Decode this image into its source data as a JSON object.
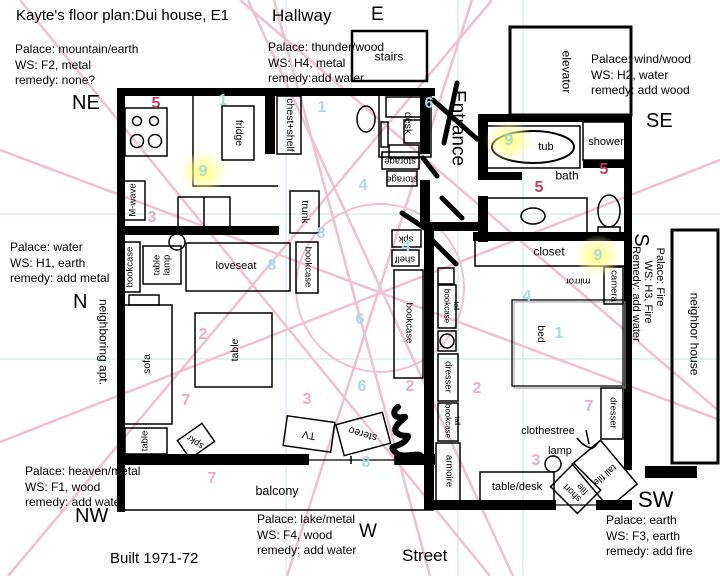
{
  "colors": {
    "star_red": "#c9395f",
    "star_pink": "#eeacbf",
    "star_cyan": "#a9dbe2",
    "sector_line_pink": "#eec3d0",
    "grid_teal": "#cdeaea",
    "highlight_yellow": "#ffff96",
    "ink": "#000000"
  },
  "labels": [
    {
      "id": "title",
      "t": "Kayte's floor plan:Dui house, E1",
      "x": 16,
      "y": 8,
      "cls": "tl t15"
    },
    {
      "id": "hallway",
      "t": "Hallway",
      "x": 272,
      "y": 6,
      "cls": "tl t17"
    },
    {
      "id": "dir-e",
      "t": "E",
      "x": 371,
      "y": 4,
      "cls": "tl t19"
    },
    {
      "id": "stairs",
      "t": "stairs",
      "x": 389,
      "y": 57,
      "cls": "c t12"
    },
    {
      "id": "palace-ne",
      "t": "Palace: mountain/earth\nWS: F2, metal\nremedy: none?",
      "x": 15,
      "y": 42,
      "cls": "tl blk"
    },
    {
      "id": "dir-ne",
      "t": "NE",
      "x": 72,
      "y": 92,
      "cls": "tl t20"
    },
    {
      "id": "palace-e",
      "t": "Palace: thunder/wood\nWS: H4, metal\nremedy:add water",
      "x": 268,
      "y": 40,
      "cls": "tl blk"
    },
    {
      "id": "palace-se",
      "t": "Palace: wind/wood\nWS: H2, water\nremedy: add wood",
      "x": 591,
      "y": 52,
      "cls": "tl blk"
    },
    {
      "id": "dir-se",
      "t": "SE",
      "x": 646,
      "y": 110,
      "cls": "tl t20"
    },
    {
      "id": "entrance",
      "t": "Entrance",
      "x": 458,
      "y": 128,
      "cls": "c t19",
      "rot": 90
    },
    {
      "id": "elevator",
      "t": "elevator",
      "x": 566,
      "y": 72,
      "cls": "c t12",
      "rot": 90
    },
    {
      "id": "tub",
      "t": "tub",
      "x": 546,
      "y": 147,
      "cls": "c t11"
    },
    {
      "id": "shower",
      "t": "shower",
      "x": 606,
      "y": 142,
      "cls": "c t11"
    },
    {
      "id": "bath",
      "t": "bath",
      "x": 567,
      "y": 176,
      "cls": "c t12"
    },
    {
      "id": "closet",
      "t": "closet",
      "x": 549,
      "y": 252,
      "cls": "c t12"
    },
    {
      "id": "camera",
      "t": "camera",
      "x": 613,
      "y": 286,
      "cls": "c t9",
      "rot": 90
    },
    {
      "id": "mirror",
      "t": "mirror",
      "x": 578,
      "y": 280,
      "cls": "c t9",
      "rot": 180
    },
    {
      "id": "dir-s",
      "t": "S",
      "x": 641,
      "y": 240,
      "cls": "c t20",
      "rot": 90
    },
    {
      "id": "palace-s-1",
      "t": "Palace: Fire",
      "x": 660,
      "y": 277,
      "cls": "c t11",
      "rot": 90
    },
    {
      "id": "palace-s-2",
      "t": "WS: H3, Fire",
      "x": 648,
      "y": 292,
      "cls": "c t11",
      "rot": 90
    },
    {
      "id": "palace-s-3",
      "t": "Remedy: add water",
      "x": 636,
      "y": 294,
      "cls": "c t11",
      "rot": 90
    },
    {
      "id": "neighbor-house",
      "t": "neighbor house",
      "x": 694,
      "y": 334,
      "cls": "c t12",
      "rot": 90
    },
    {
      "id": "palace-n",
      "t": "Palace: water\nWS: H1, earth\nremedy: add metal",
      "x": 10,
      "y": 240,
      "cls": "tl blk"
    },
    {
      "id": "dir-n",
      "t": "N",
      "x": 73,
      "y": 291,
      "cls": "tl t20"
    },
    {
      "id": "neighboring-apt",
      "t": "neighboring apt.",
      "x": 103,
      "y": 342,
      "cls": "c t12",
      "rot": 90
    },
    {
      "id": "fridge",
      "t": "fridge",
      "x": 238,
      "y": 133,
      "cls": "c t10",
      "rot": 90
    },
    {
      "id": "chest-shelf",
      "t": "chest+shelf",
      "x": 289,
      "y": 125,
      "cls": "c t10",
      "rot": 90
    },
    {
      "id": "m-wave",
      "t": "M-wave",
      "x": 134,
      "y": 200,
      "cls": "c t9",
      "rot": -90
    },
    {
      "id": "trunk",
      "t": "trunk",
      "x": 304,
      "y": 212,
      "cls": "c t10",
      "rot": 90
    },
    {
      "id": "desk",
      "t": "desk",
      "x": 407,
      "y": 123,
      "cls": "c t10",
      "rot": 90
    },
    {
      "id": "storage-1",
      "t": "storage",
      "x": 400,
      "y": 160,
      "cls": "c t9",
      "rot": 180
    },
    {
      "id": "storage-2",
      "t": "storage",
      "x": 402,
      "y": 178,
      "cls": "c t9",
      "rot": 180
    },
    {
      "id": "bookcase-nw",
      "t": "bookcase",
      "x": 131,
      "y": 267,
      "cls": "c t9",
      "rot": -90
    },
    {
      "id": "table-lamp",
      "t": "table\nlamp",
      "x": 162,
      "y": 265,
      "cls": "c t9 lh",
      "rot": -90
    },
    {
      "id": "loveseat",
      "t": "loveseat",
      "x": 236,
      "y": 266,
      "cls": "c t11"
    },
    {
      "id": "bookcase-mid",
      "t": "bookcase",
      "x": 307,
      "y": 267,
      "cls": "c t9",
      "rot": 90
    },
    {
      "id": "sofa",
      "t": "sofa",
      "x": 148,
      "y": 364,
      "cls": "c t10",
      "rot": -90
    },
    {
      "id": "table-dining",
      "t": "table",
      "x": 236,
      "y": 350,
      "cls": "c t10",
      "rot": -90
    },
    {
      "id": "table-small",
      "t": "table",
      "x": 146,
      "y": 441,
      "cls": "c t9",
      "rot": -90
    },
    {
      "id": "spkr",
      "t": "spkr",
      "x": 196,
      "y": 441,
      "cls": "c t9",
      "rot": 215
    },
    {
      "id": "tv",
      "t": "TV",
      "x": 309,
      "y": 434,
      "cls": "c t10",
      "rot": 190
    },
    {
      "id": "stereo",
      "t": "stereo",
      "x": 363,
      "y": 433,
      "cls": "c t10",
      "rot": 197
    },
    {
      "id": "spk",
      "t": "spk",
      "x": 406,
      "y": 238,
      "cls": "c t9",
      "rot": 180
    },
    {
      "id": "shelf",
      "t": "shelf",
      "x": 405,
      "y": 258,
      "cls": "c t9",
      "rot": 180
    },
    {
      "id": "bookcase-wall",
      "t": "bookcase",
      "x": 408,
      "y": 323,
      "cls": "c t9",
      "rot": 90
    },
    {
      "id": "bookcase-bed1",
      "t": "bookcase",
      "x": 446,
      "y": 306,
      "cls": "c t8",
      "rot": 90
    },
    {
      "id": "tall-1",
      "t": "tall",
      "x": 455,
      "y": 306,
      "cls": "c t7",
      "rot": 90
    },
    {
      "id": "dresser-bed-l",
      "t": "dresser",
      "x": 447,
      "y": 377,
      "cls": "c t9",
      "rot": 90
    },
    {
      "id": "bookcase-bed2",
      "t": "bookcase",
      "x": 447,
      "y": 421,
      "cls": "c t8",
      "rot": 90
    },
    {
      "id": "tall-2",
      "t": "tall",
      "x": 456,
      "y": 421,
      "cls": "c t7",
      "rot": 90
    },
    {
      "id": "armoire",
      "t": "armoire",
      "x": 448,
      "y": 471,
      "cls": "c t9",
      "rot": 90
    },
    {
      "id": "bed",
      "t": "bed",
      "x": 540,
      "y": 334,
      "cls": "c t10",
      "rot": 90
    },
    {
      "id": "dresser-bed-r",
      "t": "dresser",
      "x": 612,
      "y": 413,
      "cls": "c t9",
      "rot": 90
    },
    {
      "id": "clothestree",
      "t": "clothestree",
      "x": 548,
      "y": 431,
      "cls": "c t11"
    },
    {
      "id": "lamp",
      "t": "lamp",
      "x": 560,
      "y": 451,
      "cls": "c t11"
    },
    {
      "id": "table-desk",
      "t": "table/desk",
      "x": 517,
      "y": 487,
      "cls": "c t11"
    },
    {
      "id": "short-file",
      "t": "short\nfile",
      "x": 576,
      "y": 489,
      "cls": "c t9 lh",
      "rot": 225
    },
    {
      "id": "tall-file",
      "t": "tall file",
      "x": 604,
      "y": 474,
      "cls": "c t9",
      "rot": 140
    },
    {
      "id": "balcony",
      "t": "balcony",
      "x": 277,
      "y": 491,
      "cls": "c t13"
    },
    {
      "id": "palace-nw",
      "t": "Palace: heaven/metal\nWS: F1, wood\nremedy: add water",
      "x": 25,
      "y": 464,
      "cls": "tl blk"
    },
    {
      "id": "dir-nw",
      "t": "NW",
      "x": 75,
      "y": 505,
      "cls": "tl t20"
    },
    {
      "id": "built",
      "t": "Built 1971-72",
      "x": 110,
      "y": 551,
      "cls": "tl t15"
    },
    {
      "id": "palace-w",
      "t": "Palace: lake/metal\nWS: F4, wood\nremedy: add water",
      "x": 257,
      "y": 512,
      "cls": "tl blk"
    },
    {
      "id": "dir-w",
      "t": "W",
      "x": 359,
      "y": 521,
      "cls": "tl t19"
    },
    {
      "id": "street",
      "t": "Street",
      "x": 402,
      "y": 546,
      "cls": "tl t17"
    },
    {
      "id": "dir-sw",
      "t": "SW",
      "x": 638,
      "y": 488,
      "cls": "tl t22"
    },
    {
      "id": "palace-sw",
      "t": "Palace: earth\nWS: F3, earth\nremedy: add fire",
      "x": 606,
      "y": 513,
      "cls": "tl blk"
    }
  ],
  "stars": [
    {
      "v": "5",
      "c": "r",
      "x": 156,
      "y": 104
    },
    {
      "v": "1",
      "c": "b",
      "x": 223,
      "y": 101
    },
    {
      "v": "1",
      "c": "b",
      "x": 322,
      "y": 108
    },
    {
      "v": "6",
      "c": "b",
      "x": 429,
      "y": 104
    },
    {
      "v": "9",
      "c": "b",
      "x": 203,
      "y": 172,
      "glow": true
    },
    {
      "v": "3",
      "c": "p",
      "x": 152,
      "y": 218
    },
    {
      "v": "4",
      "c": "b",
      "x": 363,
      "y": 186
    },
    {
      "v": "8",
      "c": "b",
      "x": 321,
      "y": 234
    },
    {
      "v": "8",
      "c": "b",
      "x": 272,
      "y": 266
    },
    {
      "v": "4",
      "c": "b",
      "x": 406,
      "y": 247
    },
    {
      "v": "2",
      "c": "p",
      "x": 203,
      "y": 335
    },
    {
      "v": "6",
      "c": "b",
      "x": 360,
      "y": 320
    },
    {
      "v": "6",
      "c": "b",
      "x": 362,
      "y": 387
    },
    {
      "v": "2",
      "c": "p",
      "x": 410,
      "y": 387
    },
    {
      "v": "7",
      "c": "p",
      "x": 186,
      "y": 401
    },
    {
      "v": "3",
      "c": "p",
      "x": 307,
      "y": 400
    },
    {
      "v": "8",
      "c": "b",
      "x": 366,
      "y": 463
    },
    {
      "v": "7",
      "c": "p",
      "x": 212,
      "y": 479
    },
    {
      "v": "9",
      "c": "b",
      "x": 509,
      "y": 141,
      "glow": true
    },
    {
      "v": "5",
      "c": "r",
      "x": 604,
      "y": 170
    },
    {
      "v": "5",
      "c": "r",
      "x": 539,
      "y": 188
    },
    {
      "v": "9",
      "c": "b",
      "x": 598,
      "y": 256,
      "glow": true
    },
    {
      "v": "4",
      "c": "b",
      "x": 527,
      "y": 297
    },
    {
      "v": "1",
      "c": "b",
      "x": 559,
      "y": 334
    },
    {
      "v": "2",
      "c": "p",
      "x": 477,
      "y": 389
    },
    {
      "v": "7",
      "c": "p",
      "x": 589,
      "y": 407
    },
    {
      "v": "3",
      "c": "p",
      "x": 536,
      "y": 461
    }
  ]
}
